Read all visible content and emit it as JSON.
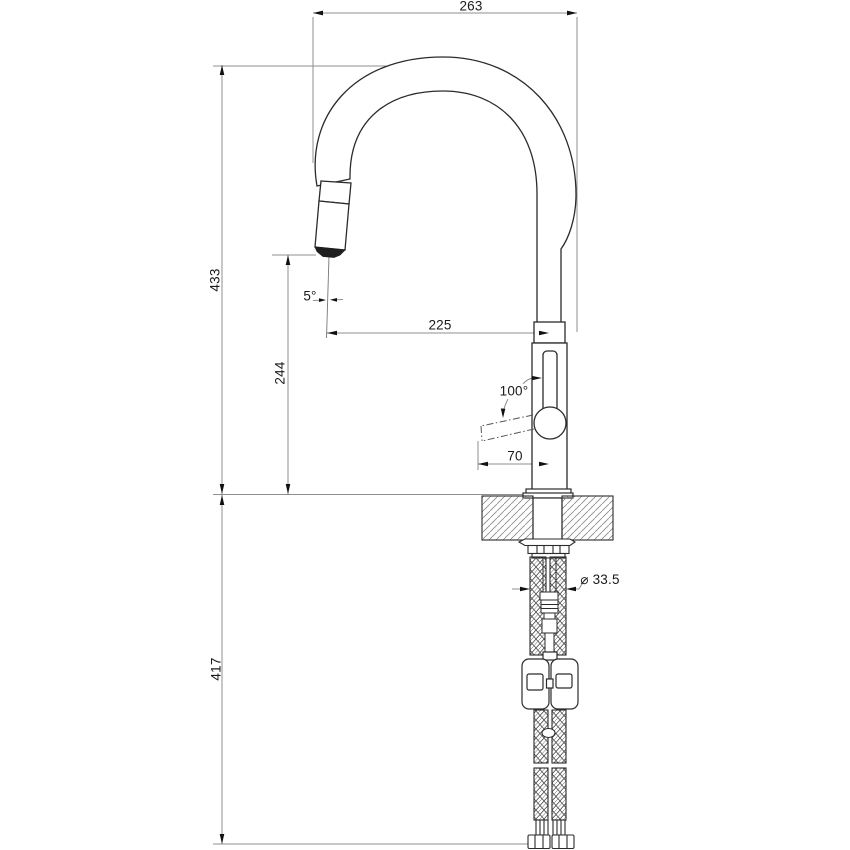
{
  "drawing": {
    "kind": "technical-dimension-drawing",
    "subject": "pull-out kitchen mixer tap, side elevation",
    "background_color": "#ffffff",
    "object_line_color": "#2b2b2b",
    "dimension_line_color": "#8f8f8f",
    "text_color": "#1a1a1a",
    "labels": {
      "overall_depth": "263",
      "height_above_deck": "433",
      "spout_outlet_height": "244",
      "spout_reach": "225",
      "outlet_angle": "5°",
      "handle_swing_angle": "100°",
      "handle_projection": "70",
      "mounting_hole_diameter": "⌀ 33.5",
      "below_deck_length": "417"
    }
  }
}
